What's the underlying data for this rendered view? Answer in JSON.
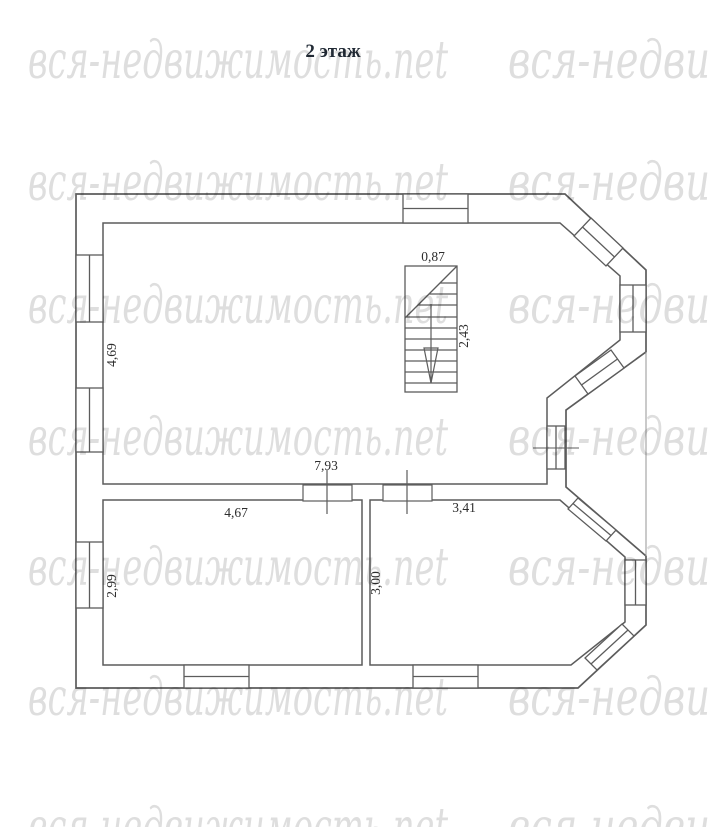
{
  "page": {
    "title": "2 этаж"
  },
  "watermark": {
    "text": "вся-недвижимость.net",
    "partial_text": "вся-недви",
    "color": "#dedede"
  },
  "floor_plan": {
    "dimensions": {
      "stairs_width": "0,87",
      "stairs_depth": "2,43",
      "main_room_depth": "4,69",
      "main_room_width": "7,93",
      "left_room_width": "4,67",
      "left_room_depth": "2,99",
      "right_room_width": "3,41",
      "right_room_depth": "3,00"
    },
    "colors": {
      "wall_line": "#5c5c5c",
      "thin_line": "#949494",
      "dimension_text": "#2d2d2d",
      "title_text": "#222b36"
    }
  }
}
